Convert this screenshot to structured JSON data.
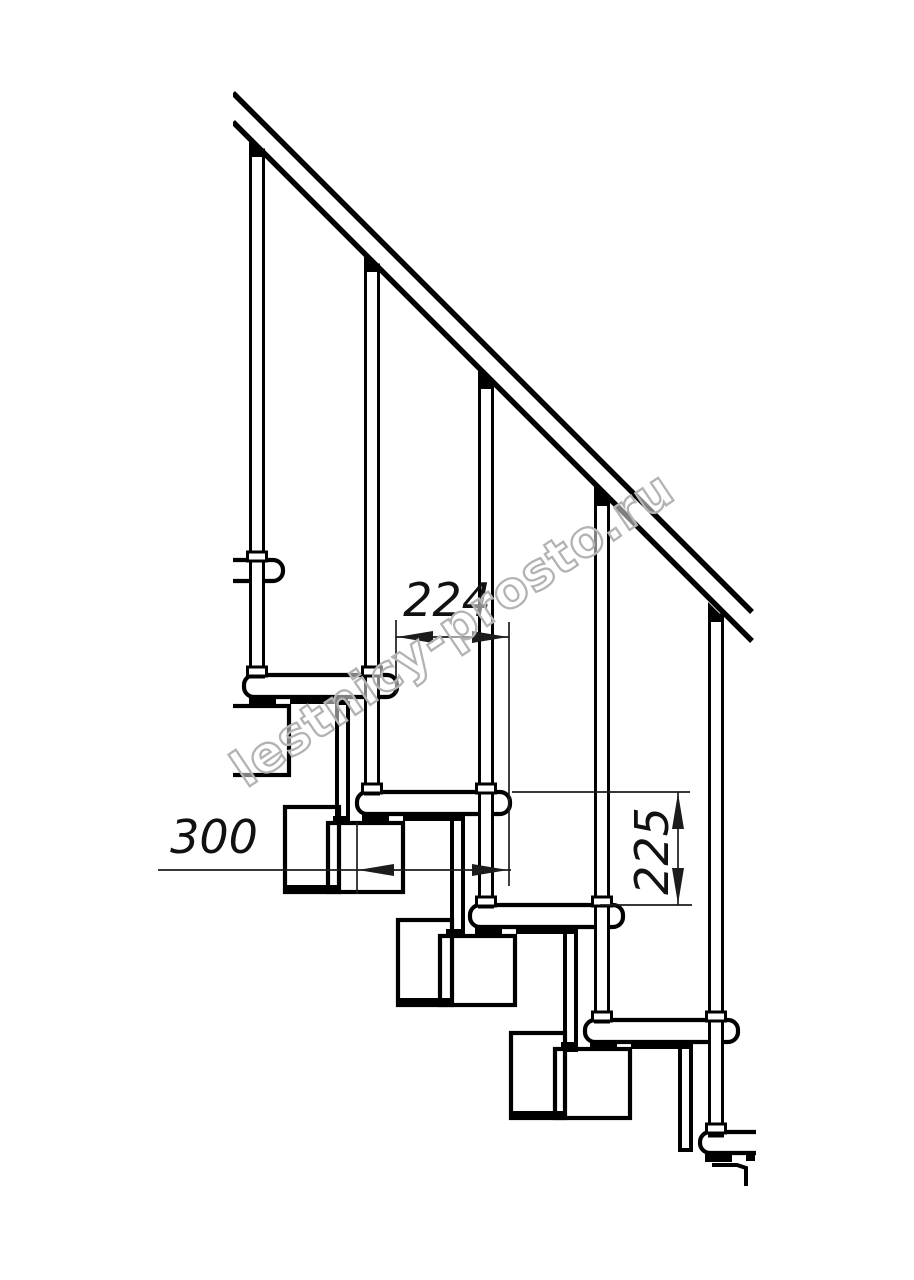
{
  "drawing": {
    "dimensions": {
      "step_run": "224",
      "tread_length": "300",
      "step_rise": "225"
    },
    "watermark": "lestnicy-prosto.ru",
    "colors": {
      "outline": "#000000",
      "dimension": "#1c1c1c",
      "watermark_outline": "#b3b3b3",
      "background": "#ffffff"
    }
  }
}
